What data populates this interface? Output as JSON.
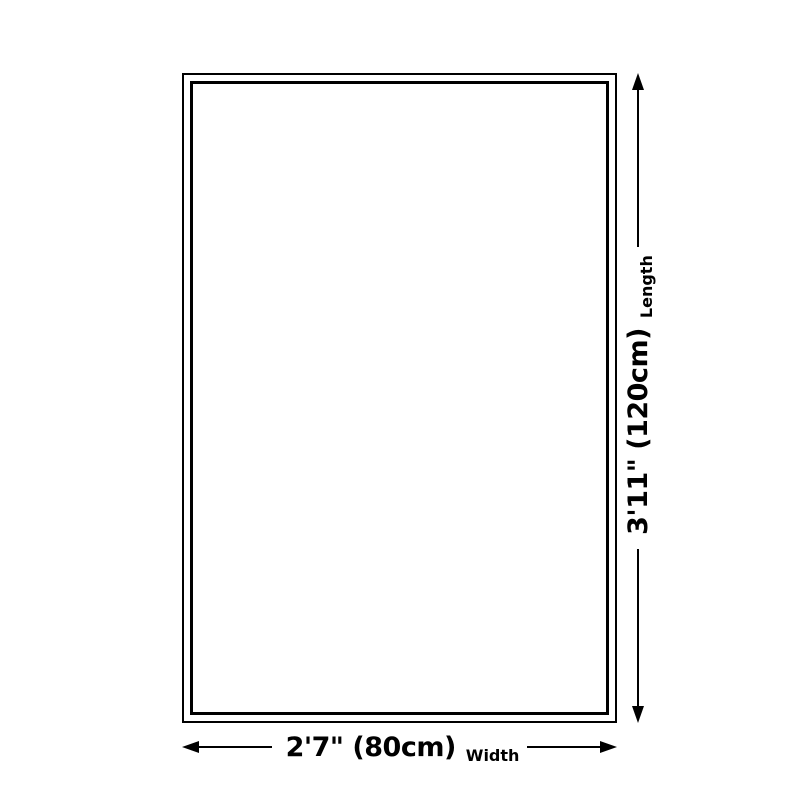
{
  "diagram": {
    "title": "product-size-diagram",
    "shape": "rectangle-outline",
    "colors": {
      "ink": "#000000",
      "surface": "#ffffff"
    },
    "dimensions": {
      "length": {
        "value": "3'11\" (120cm)",
        "label": "Length",
        "orientation": "vertical"
      },
      "width": {
        "value": "2'7\" (80cm)",
        "label": "Width",
        "orientation": "horizontal"
      }
    }
  }
}
